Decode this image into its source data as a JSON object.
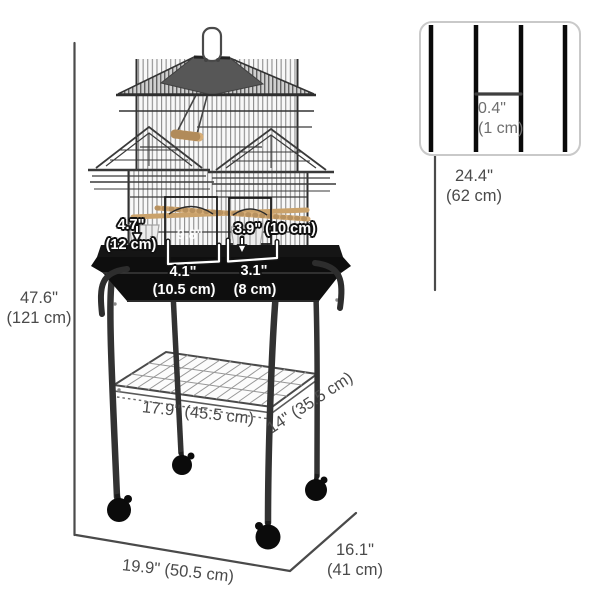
{
  "dimensions": {
    "total_height": {
      "inches": "47.6\"",
      "cm": "(121 cm)"
    },
    "cage_height": {
      "inches": "24.4\"",
      "cm": "(62 cm)"
    },
    "bar_spacing": {
      "inches": "0.4\"",
      "cm": "(1 cm)"
    },
    "left_door_depth": {
      "inches": "4.7\"",
      "cm": "(12 cm)"
    },
    "right_door": {
      "text": "3.9\" (10 cm)"
    },
    "left_door_width": {
      "inches": "4.1\"",
      "cm": "(10.5 cm)"
    },
    "right_door_width": {
      "inches": "3.1\"",
      "cm": "(8 cm)"
    },
    "partial_label": {
      "text": "9.8\""
    },
    "shelf_width": {
      "text": "17.9\" (45.5 cm)"
    },
    "shelf_depth": {
      "text": "14\" (35.5 cm)"
    },
    "base_width": {
      "text": "19.9\" (50.5 cm)"
    },
    "base_depth": {
      "inches": "16.1\"",
      "cm": "(41 cm)"
    }
  },
  "colors": {
    "label_gray": "#4a4a4a",
    "label_white": "#ffffff",
    "outline_black": "#111111",
    "wood_tan": "#d6ad77",
    "metal_dark": "#323232",
    "inset_border": "#c9c9c9"
  }
}
